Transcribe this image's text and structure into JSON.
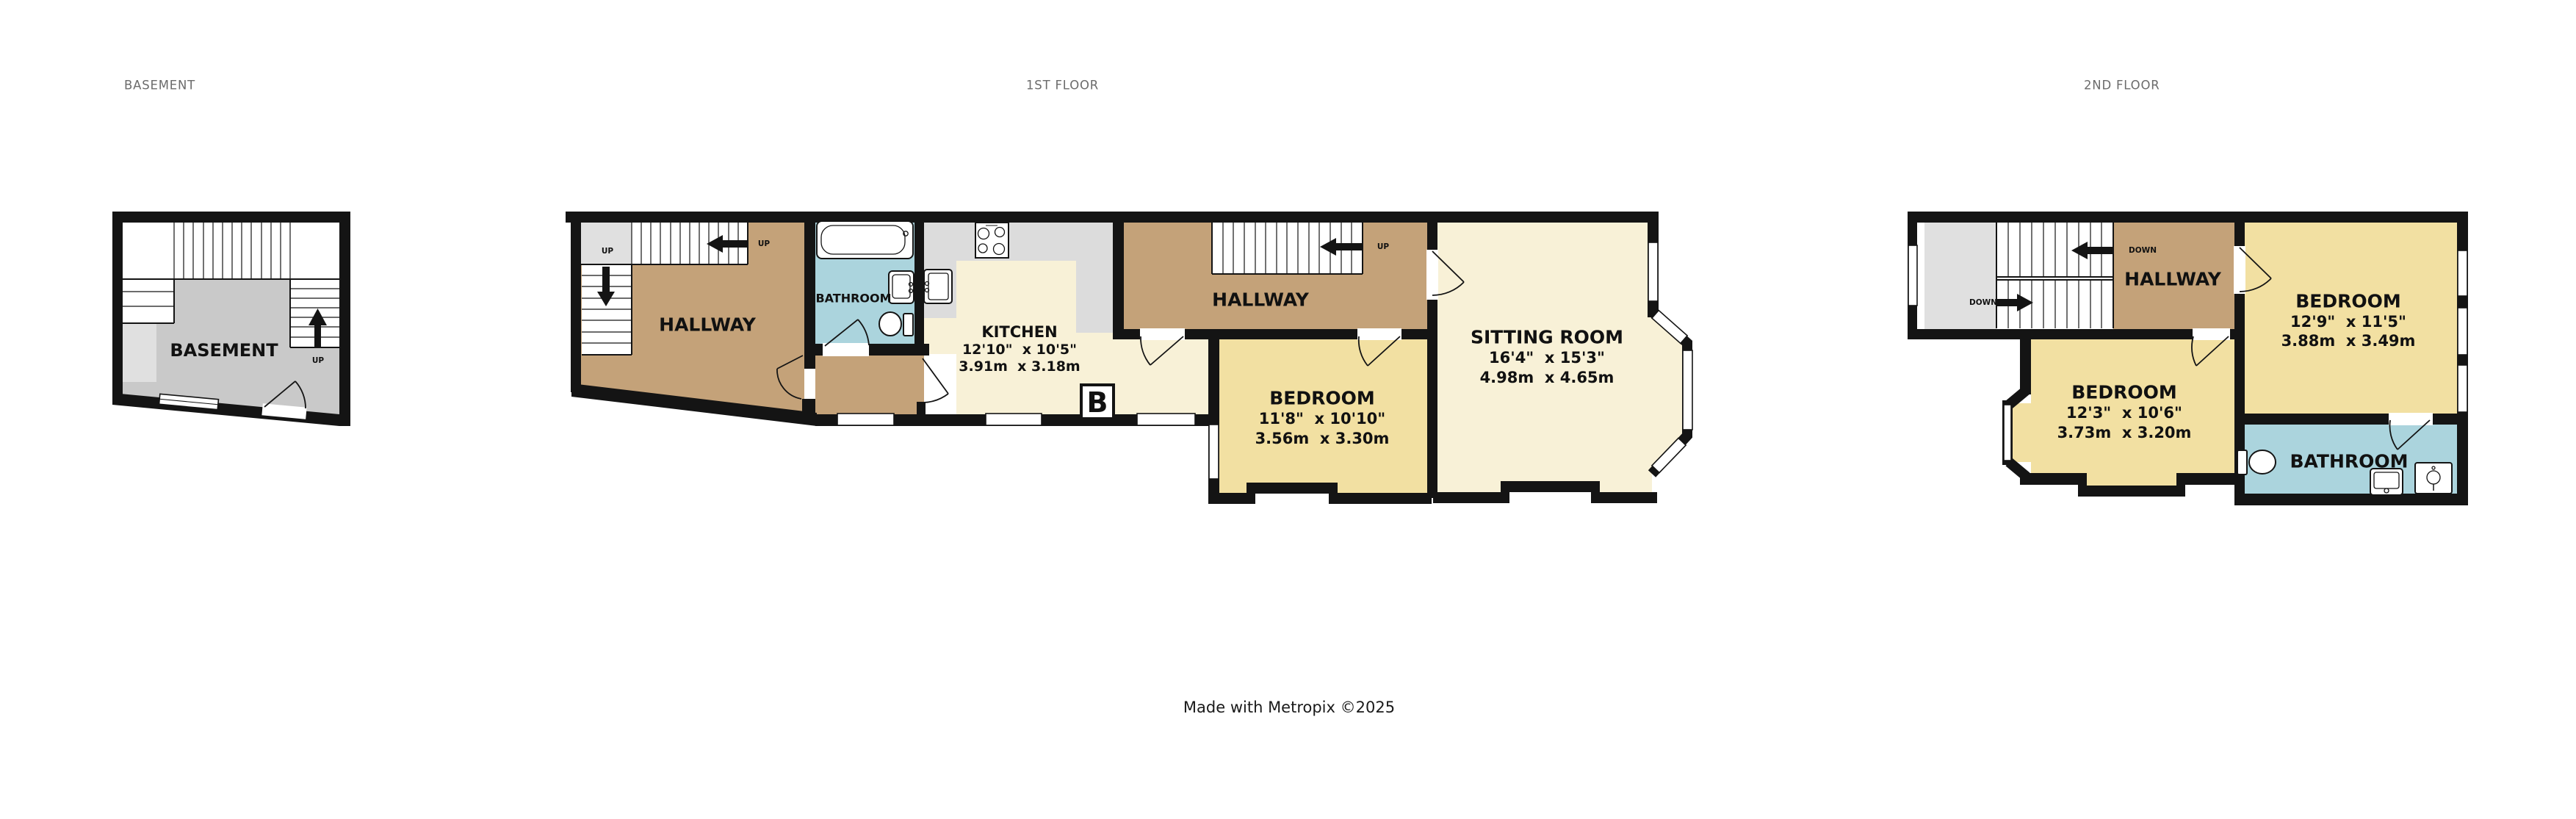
{
  "colors": {
    "wall": "#141414",
    "hallway_tan": "#C4A279",
    "bedroom_yellow": "#F2E0A2",
    "living_cream": "#F8F1D7",
    "bathroom_blue": "#ABD4DD",
    "counter_gray": "#DCDCDC",
    "basement_gray": "#C9C9C9",
    "landing_gray": "#E0E0E0",
    "title_gray": "#6b6b6b"
  },
  "titles": {
    "basement": "BASEMENT",
    "first_floor": "1ST FLOOR",
    "second_floor": "2ND FLOOR"
  },
  "footer": {
    "text": "Made with Metropix ©2025"
  },
  "basement": {
    "room_label": "BASEMENT",
    "stairs_up_label": "UP"
  },
  "first_floor": {
    "hallway_left": {
      "label": "HALLWAY",
      "landing_up": "UP",
      "stairs_up": "UP"
    },
    "bathroom": {
      "label": "BATHROOM"
    },
    "kitchen": {
      "label": "KITCHEN",
      "dims_imperial": "12'10\"  x 10'5\"",
      "dims_metric": "3.91m  x 3.18m"
    },
    "boiler": {
      "label": "B"
    },
    "hallway_mid": {
      "label": "HALLWAY",
      "stairs_up": "UP"
    },
    "bedroom": {
      "label": "BEDROOM",
      "dims_imperial": "11'8\"  x 10'10\"",
      "dims_metric": "3.56m  x 3.30m"
    },
    "sitting_room": {
      "label": "SITTING ROOM",
      "dims_imperial": "16'4\"  x 15'3\"",
      "dims_metric": "4.98m  x 4.65m"
    }
  },
  "second_floor": {
    "hallway": {
      "label": "HALLWAY",
      "stairs_down_upper": "DOWN",
      "stairs_down_lower": "DOWN"
    },
    "bedroom_left": {
      "label": "BEDROOM",
      "dims_imperial": "12'3\"  x 10'6\"",
      "dims_metric": "3.73m  x 3.20m"
    },
    "bedroom_right": {
      "label": "BEDROOM",
      "dims_imperial": "12'9\"  x 11'5\"",
      "dims_metric": "3.88m  x 3.49m"
    },
    "bathroom": {
      "label": "BATHROOM"
    }
  }
}
